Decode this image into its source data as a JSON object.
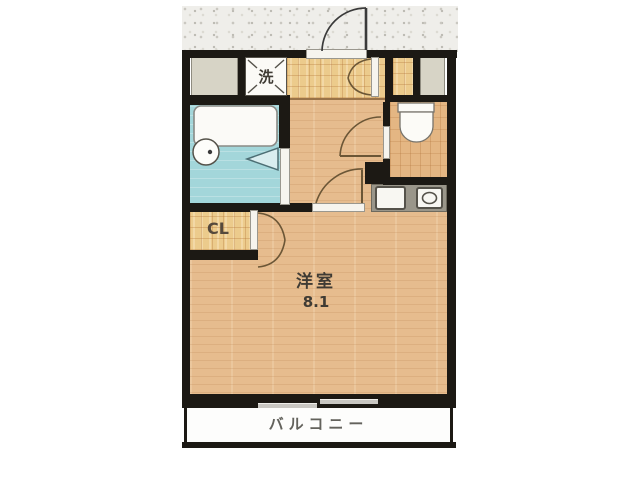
{
  "floorplan": {
    "labels": {
      "laundry": "洗",
      "closet": "CL",
      "main_room": "洋室",
      "main_room_size": "8.1",
      "balcony": "バルコニー"
    },
    "rooms": [
      {
        "name": "western-room",
        "label": "洋室",
        "size_tatami": "8.1"
      },
      {
        "name": "balcony",
        "label": "バルコニー"
      },
      {
        "name": "closet",
        "label": "CL"
      },
      {
        "name": "entrance-hall"
      },
      {
        "name": "unit-bathroom"
      },
      {
        "name": "toilet-room"
      },
      {
        "name": "kitchenette"
      }
    ],
    "fixtures": [
      "washing-machine-space",
      "bathtub",
      "washbasin",
      "bathroom-folding-door",
      "toilet",
      "kitchen-sink",
      "stove-burner",
      "entrance-door-swing",
      "shoe-cabinet-double-door",
      "closet-double-door",
      "room-door-swing",
      "toilet-door-swing",
      "balcony-sliding-window"
    ],
    "colors": {
      "wall": "#1c1914",
      "wood_floor": "#e6bc8e",
      "tile_floor": "#eccb8c",
      "bathroom_floor": "#a3d6da",
      "gray_block": "#d7d4c6",
      "counter": "#9a968a",
      "fixture_white": "#f8f7f2",
      "concrete_band": "#efeeea",
      "text": "#3f3b34"
    }
  }
}
